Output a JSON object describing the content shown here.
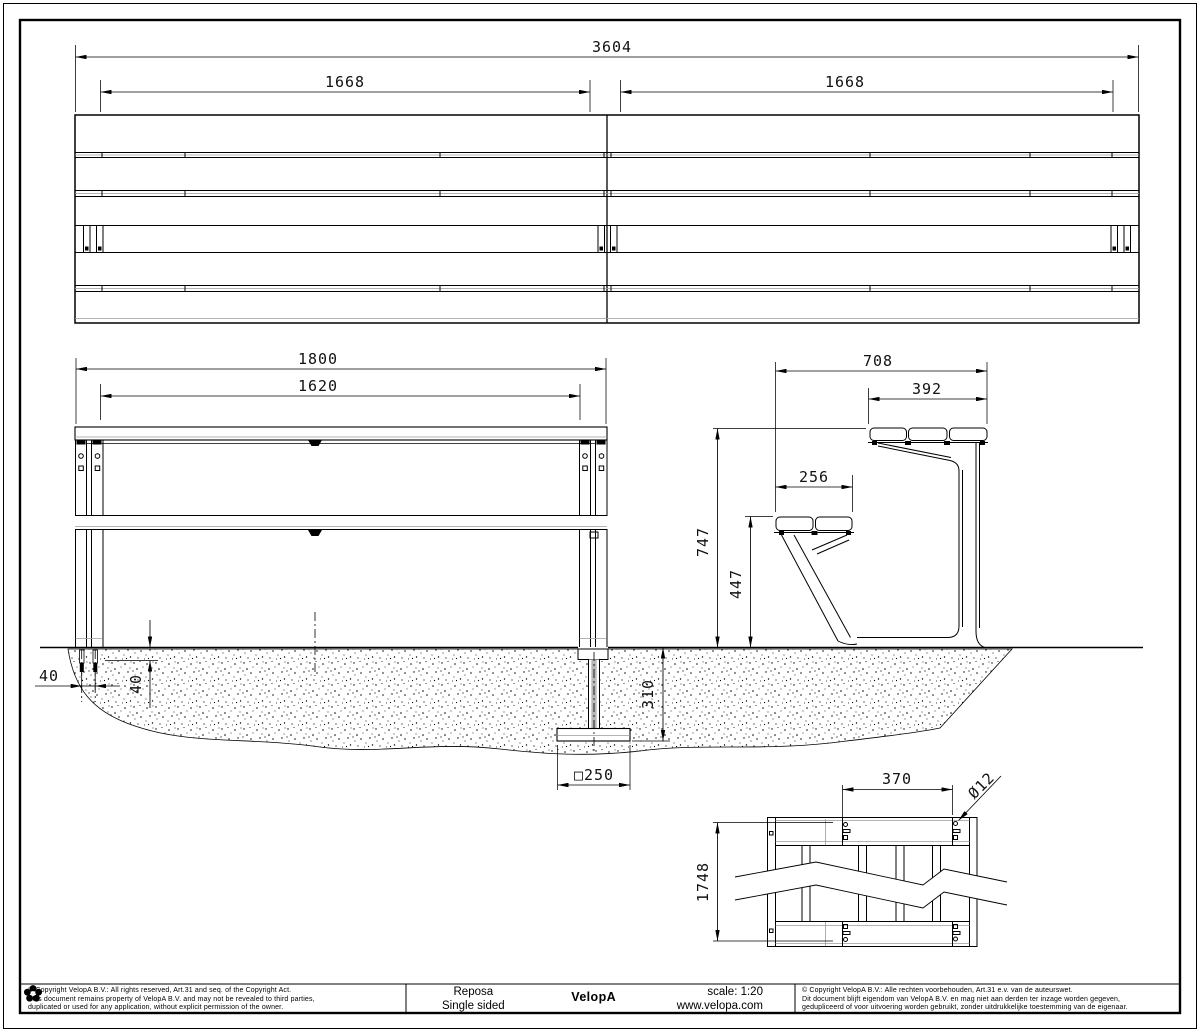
{
  "views": {
    "top": {
      "total": "3604",
      "left_span": "1668",
      "right_span": "1668"
    },
    "front": {
      "width": "1800",
      "inner": "1620",
      "anchor_spacing": "40",
      "anchor_depth_offset": "40",
      "foundation_depth": "310",
      "plate": "□250"
    },
    "side": {
      "depth": "708",
      "back_width": "392",
      "seat_depth": "256",
      "height": "747",
      "seat_height": "447"
    },
    "plan": {
      "hole_span": "370",
      "hole_dia": "Ø12",
      "length": "1748"
    }
  },
  "footer": {
    "copyright_left": {
      "line1": "© Copyright VelopA B.V.: All rights reserved, Art.31 and seq. of the Copyright Act.",
      "line2": "This document remains property of VelopA B.V. and may not be revealed to third parties,",
      "line3": "duplicated or used for any application, without explicit permission of the owner."
    },
    "product": {
      "name": "Reposa",
      "variant": "Single sided"
    },
    "brand": "VelopA",
    "scale": "scale: 1:20",
    "website": "www.velopa.com",
    "copyright_right": {
      "line1": "© Copyright VelopA B.V.: Alle rechten voorbehouden, Art.31 e.v. van de auteurswet.",
      "line2": "Dit document blijft eigendom van VelopA B.V. en mag niet aan derden ter inzage worden gegeven,",
      "line3": "gedupliceerd of voor uitvoering worden gebruikt, zonder uitdrukkelijke toestemming van de eigenaar."
    }
  }
}
